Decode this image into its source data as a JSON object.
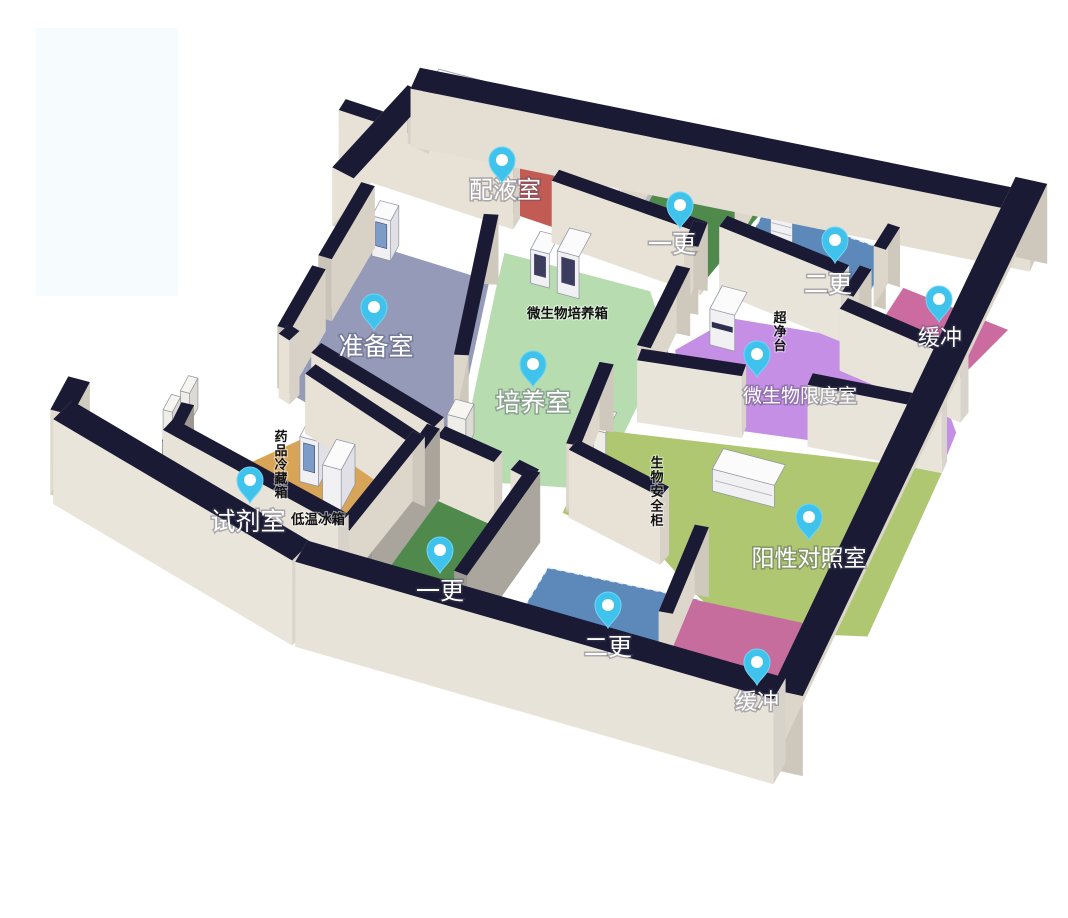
{
  "scene": {
    "kind": "laboratory-3d-floorplan",
    "background": "#ffffff"
  },
  "colors": {
    "wall_top": "#1a1a34",
    "wall_face_light": "#e9e4da",
    "corridor_floor": "#b9b8c0",
    "door_glass": "#aacbe4",
    "pin_body": "#3fc3ec",
    "pin_rim": "#6fd6f5",
    "pin_inner": "#ffffff",
    "equipment_white": "#f1f1f4",
    "watermark": "#f6fbfe"
  },
  "rooms": [
    {
      "id": "peiyeshi",
      "label": "配液室",
      "floor_color": "#c25b54"
    },
    {
      "id": "yigeng_top",
      "label": "一更",
      "floor_color": "#4f8a4c"
    },
    {
      "id": "ergeng_top",
      "label": "二更",
      "floor_color": "#5c88ba"
    },
    {
      "id": "huanchong_top",
      "label": "缓冲",
      "floor_color": "#cb6ba0"
    },
    {
      "id": "zhunbeishi",
      "label": "准备室",
      "floor_color": "#949ab8"
    },
    {
      "id": "peiyangshi",
      "label": "培养室",
      "floor_color": "#b7dcb0"
    },
    {
      "id": "weishengwu_xiandushi",
      "label": "微生物限度室",
      "floor_color": "#c48fe4"
    },
    {
      "id": "shijishi",
      "label": "试剂室",
      "floor_color": "#d8a458"
    },
    {
      "id": "yigeng_bottom",
      "label": "一更",
      "floor_color": "#4f8a4c"
    },
    {
      "id": "yangxing_duizhaoshi",
      "label": "阳性对照室",
      "floor_color": "#aec770"
    },
    {
      "id": "ergeng_bottom",
      "label": "二更",
      "floor_color": "#5c88ba"
    },
    {
      "id": "huanchong_bottom",
      "label": "缓冲",
      "floor_color": "#c76d9e"
    }
  ],
  "equipment_labels": [
    {
      "id": "weishengwu_peiyangxiang",
      "text": "微生物培养箱",
      "orientation": "horizontal"
    },
    {
      "id": "chaojingtai",
      "text": "超净台",
      "orientation": "vertical"
    },
    {
      "id": "yaopin_lengcangxiang",
      "text": "药品冷藏箱",
      "orientation": "vertical"
    },
    {
      "id": "diwen_bingxiang",
      "text": "低温冰箱",
      "orientation": "horizontal"
    },
    {
      "id": "shengwu_anquangui",
      "text": "生物安全柜",
      "orientation": "vertical"
    }
  ]
}
